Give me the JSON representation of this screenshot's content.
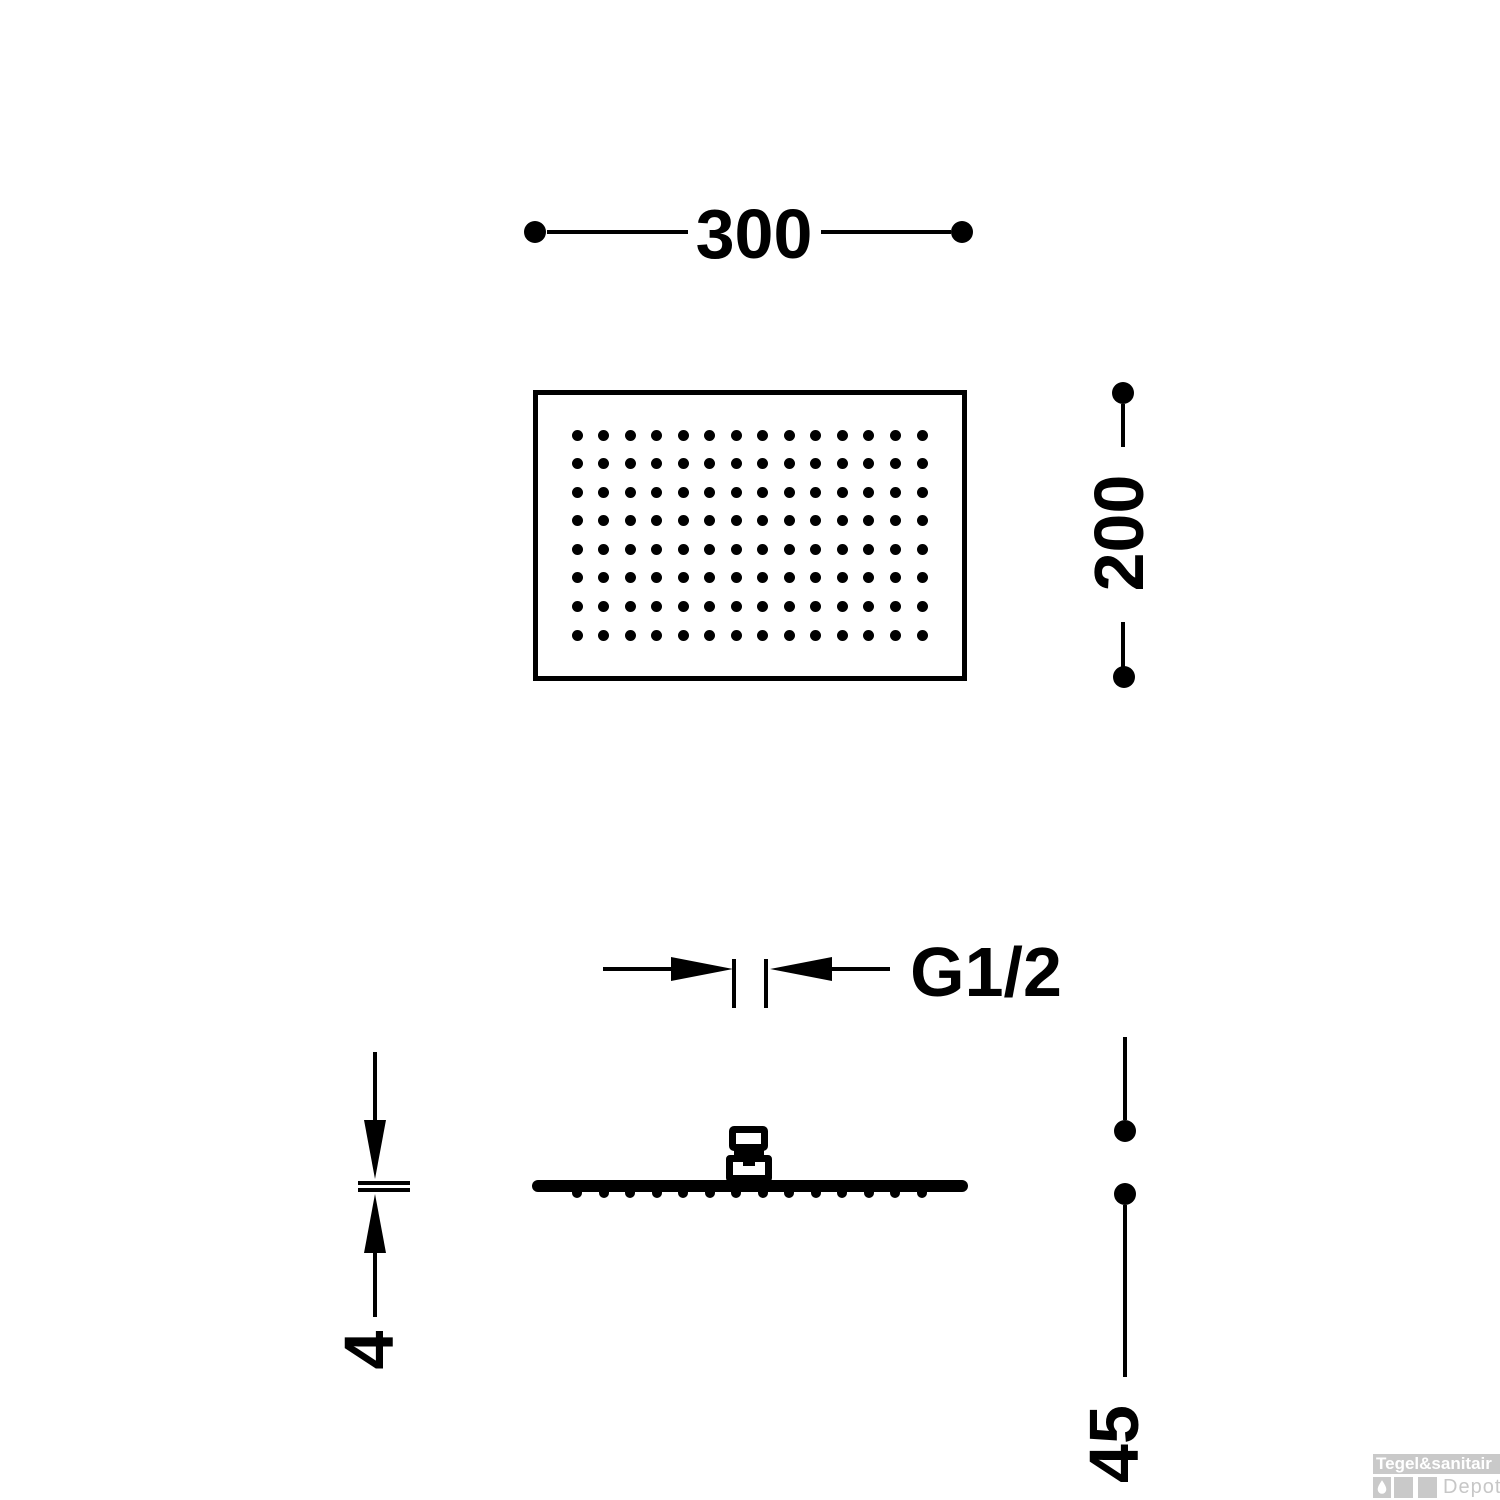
{
  "drawing": {
    "colors": {
      "line": "#000000",
      "background": "#ffffff"
    },
    "dimensions": {
      "width": "300",
      "height": "200",
      "thread": "G1/2",
      "plate_thickness": "4",
      "total_depth": "45"
    },
    "top_view": {
      "nozzle_grid": {
        "cols": 14,
        "rows": 8
      }
    },
    "side_view": {
      "nozzle_count": 14
    },
    "watermark": {
      "brand": "Tegel&sanitair",
      "sub": "Depot",
      "box_color": "#c9c9c9",
      "brand_text_color": "#ffffff",
      "sub_text_color": "#c7c7c7"
    }
  }
}
